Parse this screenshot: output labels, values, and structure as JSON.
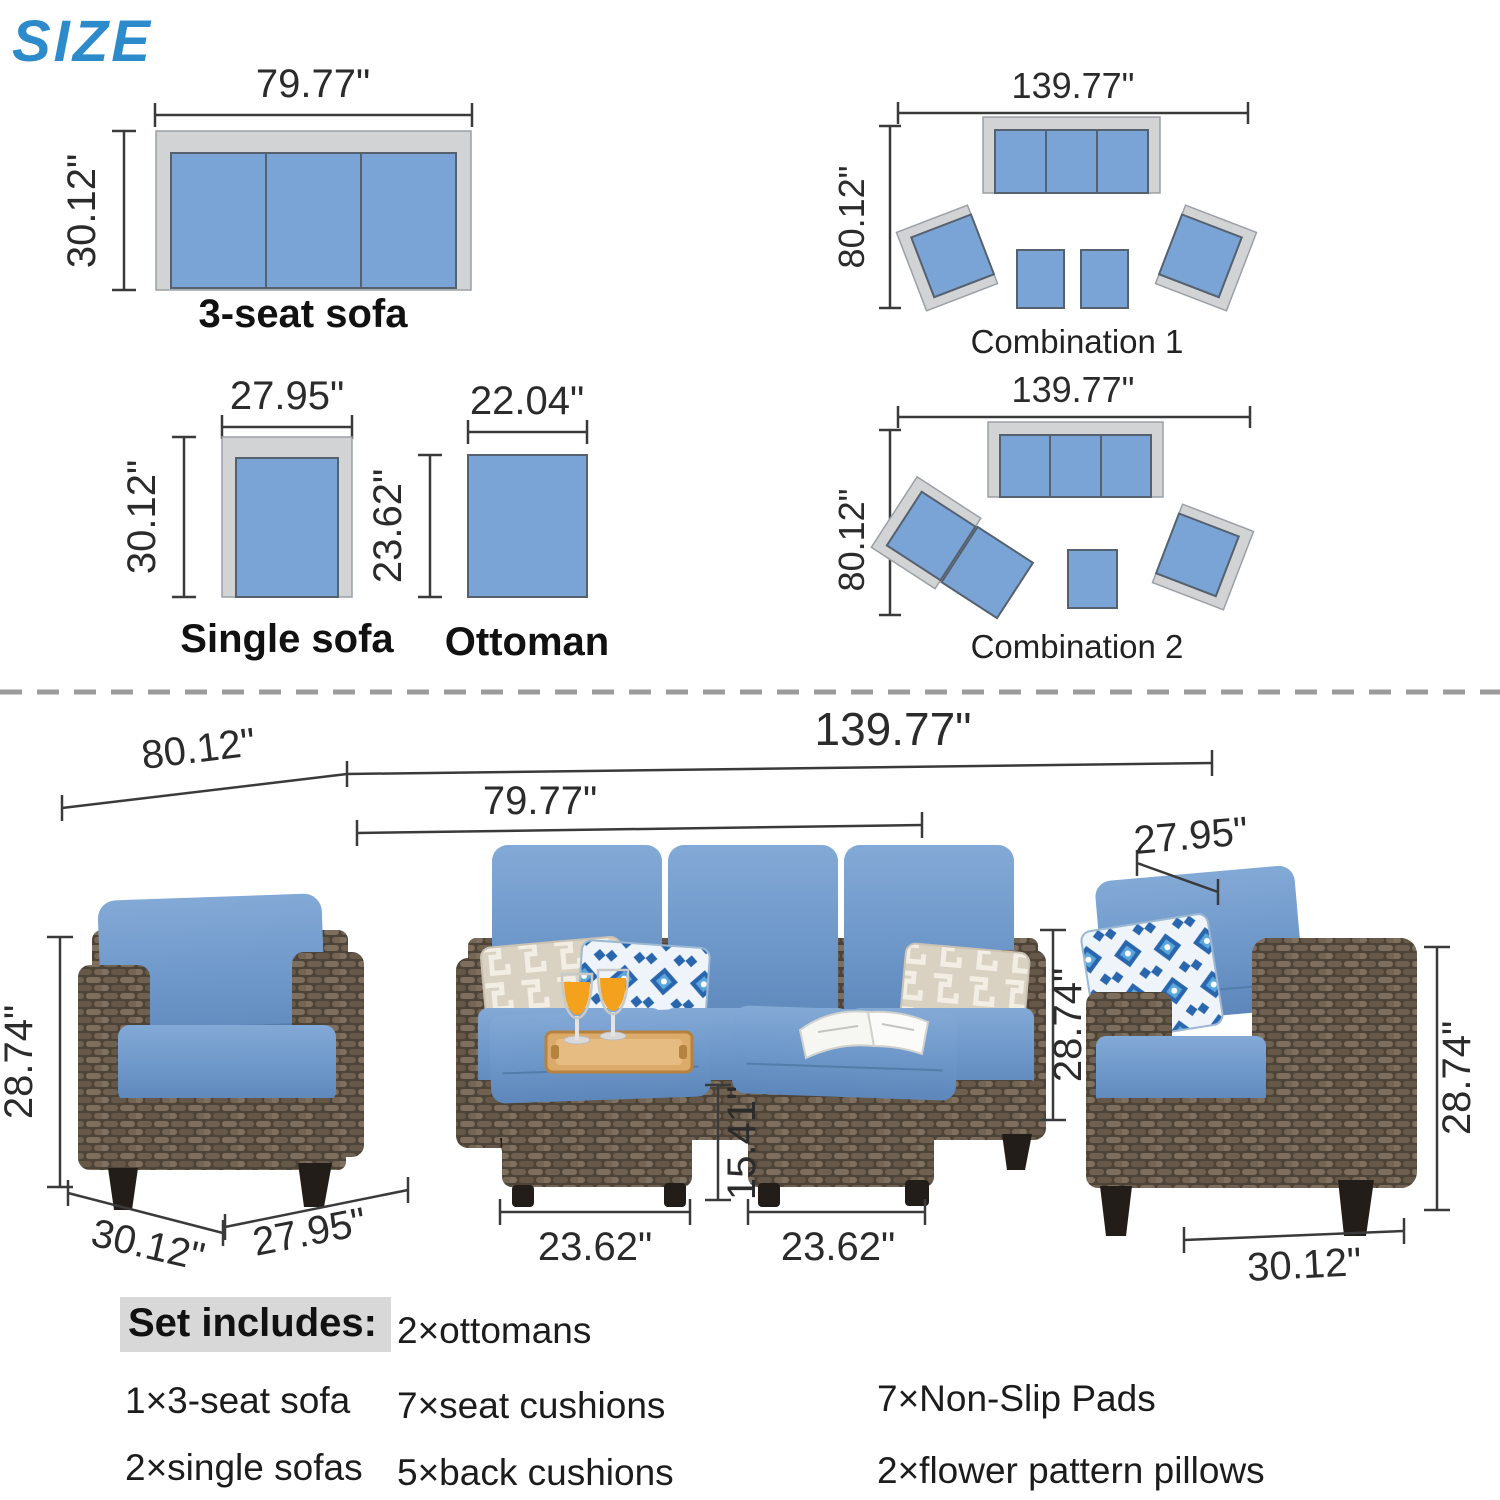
{
  "title": "SIZE",
  "colors": {
    "accent_blue": "#2E8BCB",
    "cushion_blue": "#7BA4D6",
    "frame_gray": "#D2D3D5",
    "wicker_brown": "#5E5143",
    "dimension_text": "#2B2B2B"
  },
  "diagrams": {
    "sofa3": {
      "caption": "3-seat sofa",
      "width_label": "79.77\"",
      "height_label": "30.12\""
    },
    "single_sofa": {
      "caption": "Single sofa",
      "width_label": "27.95\"",
      "height_label": "30.12\""
    },
    "ottoman": {
      "caption": "Ottoman",
      "width_label": "22.04\"",
      "height_label": "23.62\""
    },
    "combination1": {
      "caption": "Combination 1",
      "width_label": "139.77\"",
      "height_label": "80.12\""
    },
    "combination2": {
      "caption": "Combination 2",
      "width_label": "139.77\"",
      "height_label": "80.12\""
    }
  },
  "photo_dimensions": {
    "left_span": "80.12\"",
    "total_span": "139.77\"",
    "sofa_width": "79.77\"",
    "right_chair_width": "27.95\"",
    "left_chair_height": "28.74\"",
    "left_chair_depth": "30.12\"",
    "left_chair_width": "27.95\"",
    "sofa_height": "28.74\"",
    "ottoman_height": "15.41\"",
    "ottoman1_width": "23.62\"",
    "ottoman2_width": "23.62\"",
    "right_chair_height": "28.74\"",
    "right_chair_depth": "30.12\""
  },
  "set_includes": {
    "heading": "Set includes:",
    "column1": [
      "1×3-seat sofa",
      "2×single sofas"
    ],
    "column2": [
      "2×ottomans",
      "7×seat cushions",
      "5×back cushions"
    ],
    "column3": [
      "7×Non-Slip Pads",
      "2×flower pattern pillows"
    ]
  }
}
